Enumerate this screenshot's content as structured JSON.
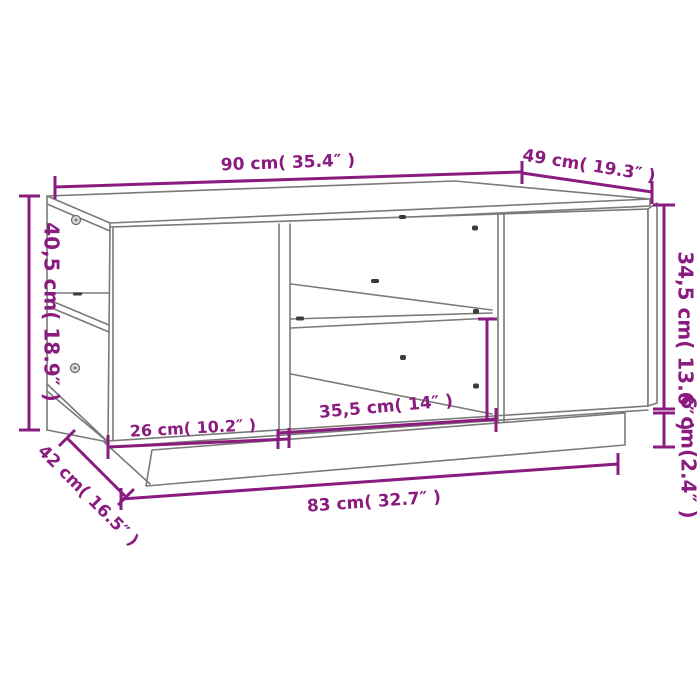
{
  "diagram": {
    "subject": "coffee-table-dimension-drawing",
    "background_color": "#ffffff",
    "drawing_line_color": "#7a7a7a",
    "dimension_color": "#8A1C80",
    "labels": {
      "top_width": "90 cm( 35.4″ )",
      "top_depth": "49 cm( 19.3″ )",
      "left_height": "40,5 cm( 18.9″ )",
      "right_height": "34,5 cm( 13.6″ )",
      "plinth_height": "6 cm(2.4″ )",
      "left_compartment_width": "26 cm( 10.2″ )",
      "middle_compartment_width": "35,5 cm( 14″ )",
      "plinth_depth": "42 cm( 16.5″ )",
      "plinth_width": "83 cm( 32.7″ )"
    }
  }
}
